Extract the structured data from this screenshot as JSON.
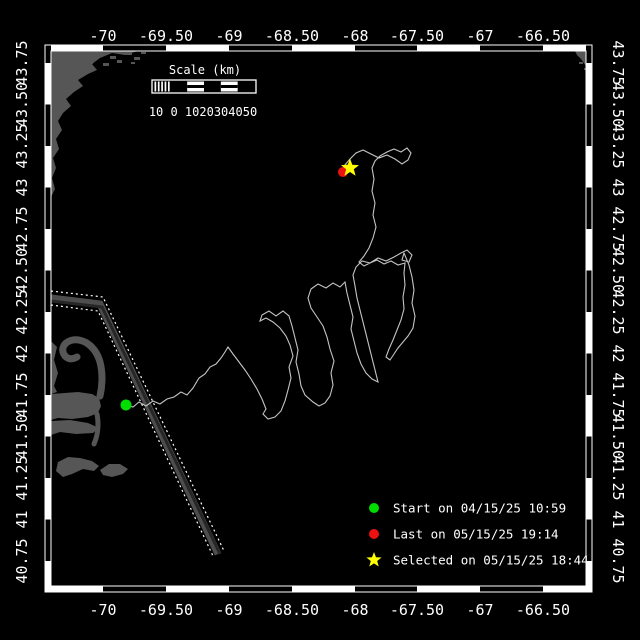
{
  "canvas": {
    "width": 640,
    "height": 640,
    "background": "#000000"
  },
  "map": {
    "colors": {
      "frame_stroke": "#ffffff",
      "land": "#565656",
      "track": "#c4c4c4",
      "lane_band": "#4d4d4d",
      "lane_band_dark": "#262626",
      "lane_boundary": "#ffffff",
      "start_marker": "#00dd00",
      "last_marker": "#ee1111",
      "selected_marker": "#ffff00"
    },
    "frame": {
      "outer": [
        45,
        45,
        547,
        547
      ],
      "inner": [
        51,
        51,
        535,
        535
      ],
      "bar": 6,
      "lon_boundaries": [
        45,
        103,
        166,
        229,
        292,
        355,
        417,
        480,
        543,
        592
      ],
      "lat_boundaries": [
        45,
        63,
        104.5,
        146,
        187.5,
        229,
        270.5,
        312,
        353.5,
        395,
        436.5,
        478,
        519.5,
        561,
        592
      ],
      "lon_first_white": true,
      "lat_first_white": false
    },
    "axis": {
      "lon_ticks": [
        {
          "label": "-70",
          "x": 103
        },
        {
          "label": "-69.50",
          "x": 166
        },
        {
          "label": "-69",
          "x": 229
        },
        {
          "label": "-68.50",
          "x": 292
        },
        {
          "label": "-68",
          "x": 355
        },
        {
          "label": "-67.50",
          "x": 417
        },
        {
          "label": "-67",
          "x": 480
        },
        {
          "label": "-66.50",
          "x": 543
        }
      ],
      "lat_ticks": [
        {
          "label": "43.75",
          "y": 63
        },
        {
          "label": "43.50",
          "y": 104.5
        },
        {
          "label": "43.25",
          "y": 146
        },
        {
          "label": "43",
          "y": 187.5
        },
        {
          "label": "42.75",
          "y": 229
        },
        {
          "label": "42.50",
          "y": 270.5
        },
        {
          "label": "42.25",
          "y": 312
        },
        {
          "label": "42",
          "y": 353.5
        },
        {
          "label": "41.75",
          "y": 395
        },
        {
          "label": "41.50",
          "y": 436.5
        },
        {
          "label": "41.25",
          "y": 478
        },
        {
          "label": "41",
          "y": 519.5
        },
        {
          "label": "40.75",
          "y": 561
        }
      ],
      "top_label_y": 41,
      "bottom_label_y": 615,
      "left_label_x": 27,
      "right_label_x": 613
    },
    "scale_bar": {
      "title": "Scale (km)",
      "numbers": "10 0 1020304050",
      "x": 152,
      "y": 80,
      "w": 104,
      "h": 13,
      "cells": [
        "hatch",
        "black",
        "striped",
        "black",
        "striped",
        "black"
      ],
      "title_x": 205,
      "title_y": 74,
      "numbers_x": 203,
      "numbers_y": 116
    },
    "legend": {
      "items": [
        {
          "symbol": "circle",
          "color": "#00dd00",
          "label": "Start on 04/15/25 10:59"
        },
        {
          "symbol": "circle",
          "color": "#ee1111",
          "label": "Last on 05/15/25 19:14"
        },
        {
          "symbol": "star",
          "color": "#ffff00",
          "label": "Selected on 05/15/25 18:44"
        }
      ],
      "symbol_x": 374,
      "text_x": 393,
      "row_y": [
        508,
        534,
        560
      ],
      "dot_r": 5,
      "star_r": 8
    },
    "markers": [
      {
        "name": "last-position-marker",
        "type": "circle",
        "color": "#ee1111",
        "cx": 343,
        "cy": 172,
        "r": 5
      },
      {
        "name": "selected-position-marker",
        "type": "star",
        "color": "#ffff00",
        "cx": 350,
        "cy": 168,
        "r": 9.5
      },
      {
        "name": "start-position-marker",
        "type": "circle",
        "color": "#00dd00",
        "cx": 126,
        "cy": 405,
        "r": 5.5
      }
    ],
    "track": {
      "width": 1.1,
      "points": [
        [
          126,
          405
        ],
        [
          133,
          407
        ],
        [
          139,
          402
        ],
        [
          146,
          406
        ],
        [
          153,
          401
        ],
        [
          160,
          404
        ],
        [
          167,
          399
        ],
        [
          174,
          397
        ],
        [
          181,
          392
        ],
        [
          187,
          395
        ],
        [
          193,
          388
        ],
        [
          199,
          378
        ],
        [
          205,
          374
        ],
        [
          210,
          367
        ],
        [
          216,
          364
        ],
        [
          221,
          358
        ],
        [
          225,
          352
        ],
        [
          228,
          347
        ],
        [
          233,
          354
        ],
        [
          239,
          362
        ],
        [
          245,
          370
        ],
        [
          251,
          379
        ],
        [
          257,
          389
        ],
        [
          262,
          399
        ],
        [
          266,
          409
        ],
        [
          263,
          414
        ],
        [
          268,
          419
        ],
        [
          275,
          417
        ],
        [
          281,
          411
        ],
        [
          285,
          401
        ],
        [
          288,
          390
        ],
        [
          291,
          378
        ],
        [
          289,
          367
        ],
        [
          293,
          356
        ],
        [
          290,
          345
        ],
        [
          286,
          336
        ],
        [
          280,
          328
        ],
        [
          273,
          322
        ],
        [
          266,
          318
        ],
        [
          260,
          321
        ],
        [
          262,
          315
        ],
        [
          269,
          311
        ],
        [
          276,
          316
        ],
        [
          283,
          311
        ],
        [
          289,
          316
        ],
        [
          292,
          326
        ],
        [
          295,
          338
        ],
        [
          298,
          350
        ],
        [
          296,
          362
        ],
        [
          299,
          374
        ],
        [
          301,
          386
        ],
        [
          305,
          395
        ],
        [
          313,
          402
        ],
        [
          319,
          406
        ],
        [
          325,
          403
        ],
        [
          330,
          396
        ],
        [
          333,
          385
        ],
        [
          331,
          373
        ],
        [
          334,
          361
        ],
        [
          330,
          349
        ],
        [
          327,
          337
        ],
        [
          323,
          326
        ],
        [
          317,
          317
        ],
        [
          311,
          308
        ],
        [
          308,
          298
        ],
        [
          311,
          289
        ],
        [
          318,
          284
        ],
        [
          326,
          288
        ],
        [
          333,
          283
        ],
        [
          340,
          287
        ],
        [
          345,
          282
        ],
        [
          347,
          293
        ],
        [
          350,
          305
        ],
        [
          353,
          317
        ],
        [
          351,
          329
        ],
        [
          354,
          341
        ],
        [
          357,
          353
        ],
        [
          361,
          364
        ],
        [
          366,
          373
        ],
        [
          372,
          379
        ],
        [
          378,
          382
        ],
        [
          375,
          370
        ],
        [
          372,
          358
        ],
        [
          369,
          346
        ],
        [
          366,
          334
        ],
        [
          363,
          322
        ],
        [
          360,
          310
        ],
        [
          357,
          298
        ],
        [
          355,
          286
        ],
        [
          353,
          275
        ],
        [
          356,
          267
        ],
        [
          362,
          261
        ],
        [
          370,
          263
        ],
        [
          378,
          258
        ],
        [
          386,
          261
        ],
        [
          394,
          257
        ],
        [
          401,
          253
        ],
        [
          407,
          250
        ],
        [
          412,
          255
        ],
        [
          409,
          262
        ],
        [
          402,
          260
        ],
        [
          404,
          253
        ],
        [
          409,
          265
        ],
        [
          412,
          277
        ],
        [
          414,
          290
        ],
        [
          412,
          303
        ],
        [
          415,
          316
        ],
        [
          413,
          328
        ],
        [
          408,
          336
        ],
        [
          403,
          342
        ],
        [
          398,
          348
        ],
        [
          394,
          354
        ],
        [
          390,
          360
        ],
        [
          386,
          357
        ],
        [
          389,
          349
        ],
        [
          393,
          340
        ],
        [
          397,
          330
        ],
        [
          401,
          320
        ],
        [
          404,
          309
        ],
        [
          403,
          297
        ],
        [
          405,
          285
        ],
        [
          404,
          273
        ],
        [
          405,
          263
        ],
        [
          398,
          265
        ],
        [
          391,
          261
        ],
        [
          384,
          264
        ],
        [
          377,
          260
        ],
        [
          370,
          263
        ],
        [
          364,
          266
        ],
        [
          359,
          262
        ],
        [
          364,
          256
        ],
        [
          369,
          248
        ],
        [
          373,
          238
        ],
        [
          376,
          227
        ],
        [
          373,
          215
        ],
        [
          375,
          203
        ],
        [
          372,
          191
        ],
        [
          374,
          179
        ],
        [
          372,
          168
        ],
        [
          375,
          161
        ],
        [
          380,
          156
        ],
        [
          387,
          152
        ],
        [
          394,
          149
        ],
        [
          401,
          152
        ],
        [
          407,
          148
        ],
        [
          411,
          153
        ],
        [
          408,
          160
        ],
        [
          402,
          164
        ],
        [
          395,
          159
        ],
        [
          387,
          155
        ],
        [
          379,
          158
        ],
        [
          371,
          154
        ],
        [
          363,
          150
        ],
        [
          356,
          153
        ],
        [
          350,
          159
        ],
        [
          344,
          166
        ],
        [
          342,
          170
        ]
      ]
    },
    "shipping_lane": {
      "bands": [
        {
          "d": "M51,298 L100,304 L218,554",
          "color": "#4d4d4d",
          "w": 7
        },
        {
          "d": "M51,301 L102,307 L220,554",
          "color": "#262626",
          "w": 3
        }
      ],
      "boundaries": [
        {
          "d": "M51,291 L103,297 L224,551"
        },
        {
          "d": "M51,305 L98,311 L213,556"
        }
      ],
      "dash": "2 3"
    },
    "land": {
      "shapes": [
        {
          "d": "M51,51 L138,51 L125,55 L112,53 L100,58 L92,64 L97,70 L88,74 L78,80 L83,86 L74,92 L66,99 L71,106 L63,113 L58,121 L62,130 L56,139 L59,149 L53,158 L56,168 L52,178 L55,189 L51,197 Z"
        },
        {
          "d": "M575,51 L586,51 L586,66 L581,59 L577,55 Z"
        },
        {
          "d": "M51,394 L78,392 L92,394 L99,398 L101,406 L98,413 L88,417 L72,419 L58,418 L51,420 Z"
        },
        {
          "d": "M51,341 L57,347 L54,360 L58,373 L54,386 L57,392 L51,394 Z"
        },
        {
          "d": "M51,421 L70,420 L88,423 L99,428 L93,433 L76,434 L60,432 L51,435 Z"
        },
        {
          "d": "M58,462 L68,457 L80,458 L92,461 L99,466 L94,471 L83,469 L72,474 L63,477 L56,471 Z"
        },
        {
          "d": "M100,470 L109,464 L120,464 L128,469 L123,474 L112,477 L103,475 Z"
        }
      ],
      "strokes": [
        {
          "d": "M100,396 Q104,378 100,362 Q96,348 85,342 Q74,337 66,343 Q60,349 65,356 Q70,361 77,357",
          "w": 7
        },
        {
          "d": "M97,414 Q100,430 94,444",
          "w": 5
        }
      ],
      "speckles": [
        [
          66,
          53,
          6,
          3
        ],
        [
          78,
          57,
          8,
          3
        ],
        [
          95,
          54,
          7,
          3
        ],
        [
          110,
          56,
          6,
          3
        ],
        [
          124,
          52,
          8,
          3
        ],
        [
          134,
          57,
          6,
          3
        ],
        [
          88,
          61,
          5,
          3
        ],
        [
          103,
          63,
          6,
          3
        ],
        [
          117,
          60,
          5,
          3
        ],
        [
          70,
          60,
          4,
          3
        ],
        [
          141,
          52,
          5,
          2
        ],
        [
          131,
          62,
          4,
          2
        ],
        [
          579,
          62,
          4,
          2
        ],
        [
          584,
          68,
          3,
          2
        ]
      ]
    }
  }
}
